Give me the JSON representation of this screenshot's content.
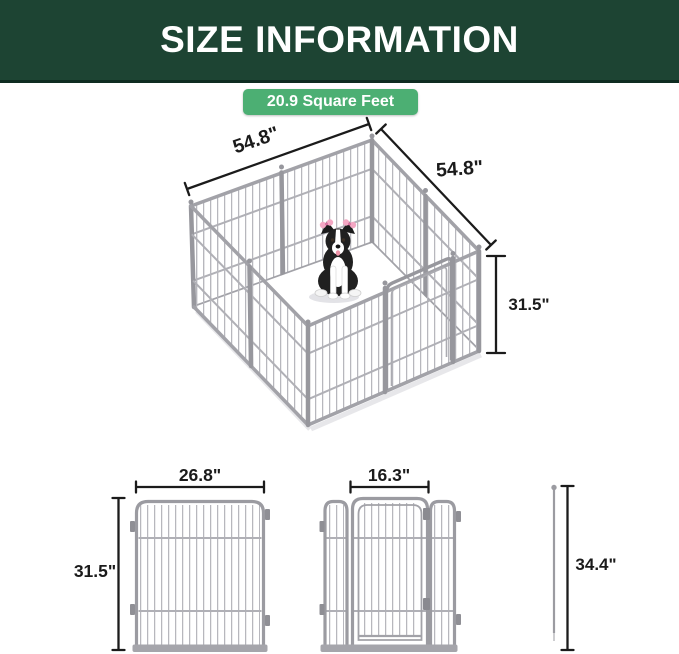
{
  "header": {
    "title": "SIZE INFORMATION"
  },
  "area_badge": {
    "label": "20.9 Square Feet"
  },
  "pen_3d": {
    "width_left_label": "54.8\"",
    "width_right_label": "54.8\"",
    "height_label": "31.5\""
  },
  "panel_diagram": {
    "width_label": "26.8\"",
    "height_label": "31.5\""
  },
  "gate_diagram": {
    "door_width_label": "16.3\""
  },
  "stake_diagram": {
    "height_label": "34.4\""
  },
  "colors": {
    "header_bg": "#1d4433",
    "header_border": "#0e2c21",
    "badge_bg": "#4caf73",
    "badge_text": "#ffffff",
    "dimension_ink": "#1b1b1b",
    "fence_gray": "#9b9ba1",
    "dog_black": "#202020",
    "bow_pink": "#f3a7c3"
  }
}
